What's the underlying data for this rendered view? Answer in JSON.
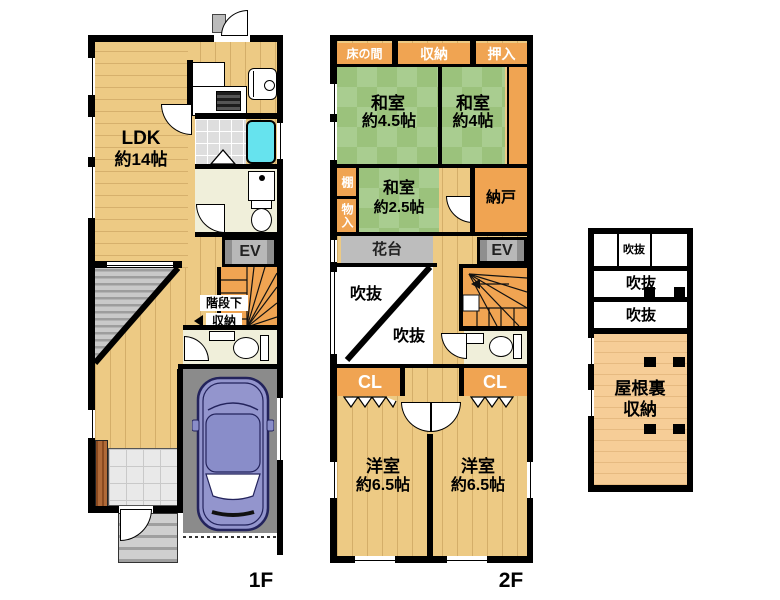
{
  "drawing": {
    "type": "japanese-floor-plan",
    "floors_shown": [
      "1F",
      "2F",
      "attic"
    ]
  },
  "f1": {
    "floor_label": "1F",
    "ldk_name": "LDK",
    "ldk_size": "約14帖",
    "ev_label": "EV",
    "understairs_line1": "階段下",
    "understairs_line2": "収納"
  },
  "f2": {
    "floor_label": "2F",
    "tokonoma": "床の間",
    "closet_top": "収納",
    "oshiire": "押入",
    "washitsu_45_name": "和室",
    "washitsu_45_size": "約4.5帖",
    "washitsu_4_name": "和室",
    "washitsu_4_size": "約4帖",
    "shelf": "棚",
    "storage_side": "物入",
    "washitsu_25_name": "和室",
    "washitsu_25_size": "約2.5帖",
    "nando": "納戸",
    "flower_stand": "花台",
    "ev_label": "EV",
    "void_upper": "吹抜",
    "void_lower": "吹抜",
    "closet_left": "CL",
    "closet_right": "CL",
    "yoshitsu_left_name": "洋室",
    "yoshitsu_left_size": "約6.5帖",
    "yoshitsu_right_name": "洋室",
    "yoshitsu_right_size": "約6.5帖"
  },
  "attic": {
    "void_top": "吹抜",
    "void_mid": "吹抜",
    "void_bottom": "吹抜",
    "storage_line1": "屋根裏",
    "storage_line2": "収納"
  },
  "colors": {
    "wall": "#000000",
    "wood_floor": "#edca84",
    "tatami_green": "#a9cd90",
    "tatami_green_alt": "#9bc27c",
    "closet_orange": "#f0a452",
    "ev_gray": "#b8b8b8",
    "flower_stand_gray": "#bdbdbd",
    "garage_gray": "#8b8b8b",
    "car_body": "#9395cd",
    "bathtub_cyan": "#66e3ee",
    "bath_tile": "#dedede",
    "washroom_cream": "#f0efda",
    "attic_orange": "#f6cd97",
    "terrace_gray": "#c9c9c9",
    "entry_brown": "#a5622f"
  }
}
